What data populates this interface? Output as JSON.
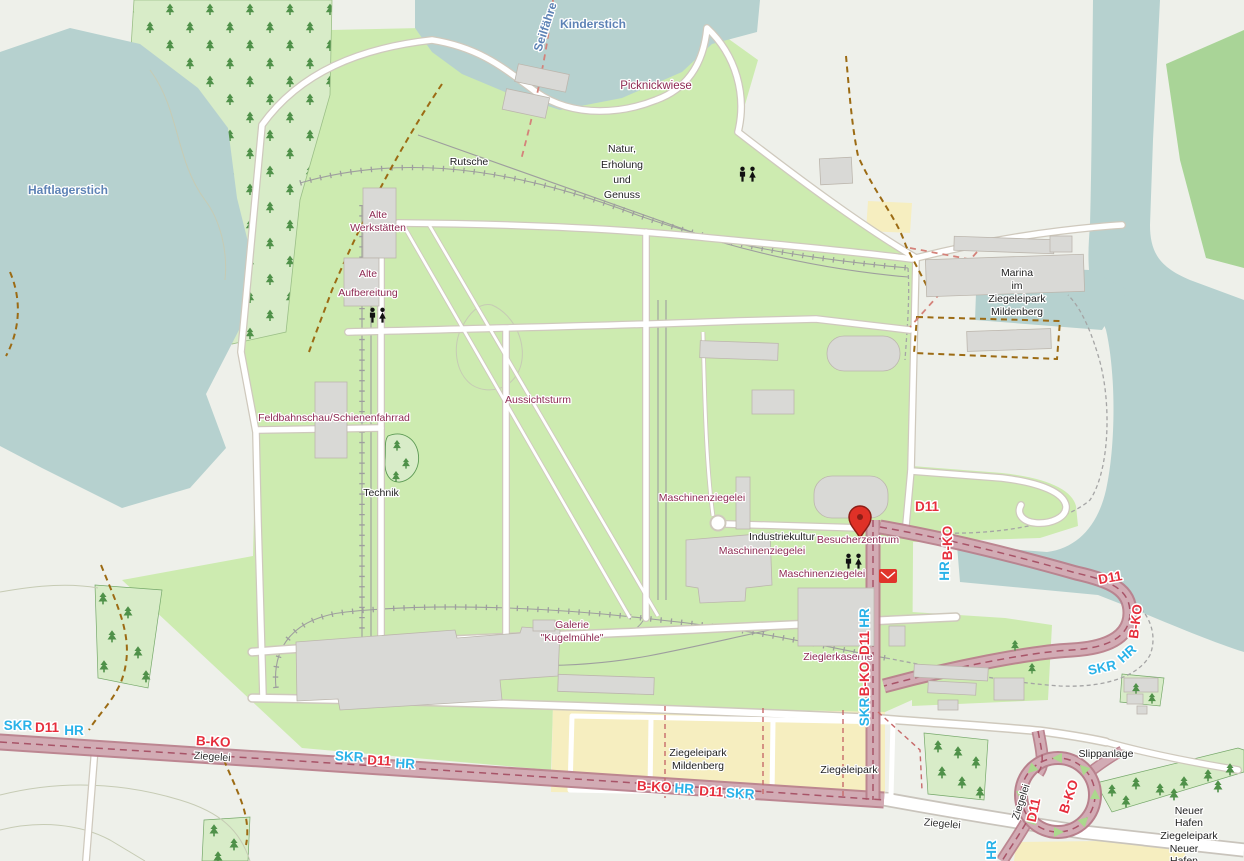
{
  "colors": {
    "water": "#b6d1cf",
    "grass": "#cdebb0",
    "wood": "#a9d497",
    "forest": "#d8ecc8",
    "sand": "#f6eec0",
    "building": "#d9d9d6",
    "route_overlay": "#d2abb4",
    "route_casing": "#b8808c",
    "route_red": "#e62e3c",
    "route_cyan": "#29b2e8",
    "poi_label": "#8e2a52",
    "general_label": "#222222",
    "water_label": "#5d82b5",
    "street_label": "#333333",
    "trail": "#9c6b14",
    "railway": "#9e9e9e"
  },
  "labels": {
    "water": [
      {
        "name": "seilfaehre",
        "text": "Seilfähre"
      },
      {
        "name": "kinderstich",
        "text": "Kinderstich"
      },
      {
        "name": "haftlagerstich",
        "text": "Haftlagerstich"
      }
    ],
    "poi": [
      {
        "name": "picknickwiese",
        "text": "Picknickwiese"
      },
      {
        "name": "alte-werkstaetten",
        "lines": [
          "Alte",
          "Werkstätten"
        ]
      },
      {
        "name": "alte-aufbereitung",
        "lines": [
          "Alte",
          "Aufbereitung"
        ]
      },
      {
        "name": "feldbahnschau",
        "text": "Feldbahnschau/Schienenfahrrad"
      },
      {
        "name": "aussichtsturm",
        "text": "Aussichtsturm"
      },
      {
        "name": "maschinenziegelei-nw",
        "text": "Maschinenziegelei"
      },
      {
        "name": "maschinenziegelei-mid",
        "text": "Maschinenziegelei"
      },
      {
        "name": "maschinenziegelei-se",
        "text": "Maschinenziegelei"
      },
      {
        "name": "besucherzentrum",
        "text": "Besucherzentrum"
      },
      {
        "name": "galerie-kugelmuehle",
        "lines": [
          "Galerie",
          "\"Kugelmühle\""
        ]
      },
      {
        "name": "zieglerkaserne",
        "text": "Zieglerkaserne"
      }
    ],
    "general": [
      {
        "name": "rutsche",
        "text": "Rutsche"
      },
      {
        "name": "natur-erholung",
        "lines": [
          "Natur,",
          "Erholung",
          "und",
          "Genuss"
        ]
      },
      {
        "name": "industriekultur",
        "text": "Industriekultur"
      },
      {
        "name": "technik",
        "text": "Technik"
      },
      {
        "name": "marina",
        "lines": [
          "Marina",
          "im",
          "Ziegeleipark",
          "Mildenberg"
        ]
      },
      {
        "name": "ziegeleipark-mildenberg",
        "lines": [
          "Ziegeleipark",
          "Mildenberg"
        ]
      },
      {
        "name": "ziegeleipark",
        "text": "Ziegeleipark"
      },
      {
        "name": "slippanlage",
        "text": "Slippanlage"
      },
      {
        "name": "neuer-hafen-ziegeleipark",
        "lines": [
          "Neuer",
          "Hafen",
          "Ziegeleipark"
        ]
      },
      {
        "name": "neuer-hafen",
        "lines": [
          "Neuer",
          "Hafen"
        ]
      }
    ],
    "streets": [
      {
        "name": "ziegelei-west",
        "text": "Ziegelei"
      },
      {
        "name": "ziegelei-east",
        "text": "Ziegelei"
      },
      {
        "name": "ziegelei-loop",
        "text": "Ziegelei"
      }
    ],
    "routes": [
      {
        "text": "SKR",
        "color": "cyan"
      },
      {
        "text": "D11",
        "color": "red"
      },
      {
        "text": "HR",
        "color": "cyan"
      },
      {
        "text": "B-KO",
        "color": "red"
      },
      {
        "text": "SKR",
        "color": "cyan"
      },
      {
        "text": "D11",
        "color": "red"
      },
      {
        "text": "HR",
        "color": "cyan"
      },
      {
        "text": "B-KO",
        "color": "red"
      },
      {
        "text": "HR",
        "color": "cyan"
      },
      {
        "text": "D11",
        "color": "red"
      },
      {
        "text": "SKR",
        "color": "cyan"
      },
      {
        "text": "D11",
        "color": "red"
      },
      {
        "text": "B-KO",
        "color": "red"
      },
      {
        "text": "HR",
        "color": "cyan"
      },
      {
        "text": "D11",
        "color": "red"
      },
      {
        "text": "B-KO",
        "color": "red"
      },
      {
        "text": "HR",
        "color": "cyan"
      },
      {
        "text": "SKR",
        "color": "cyan"
      },
      {
        "text": "HR",
        "color": "cyan"
      },
      {
        "text": "D11",
        "color": "red"
      },
      {
        "text": "B-KO",
        "color": "red"
      },
      {
        "text": "SKR",
        "color": "cyan"
      },
      {
        "text": "D11",
        "color": "red"
      },
      {
        "text": "B-KO",
        "color": "red"
      },
      {
        "text": "HR",
        "color": "cyan"
      }
    ]
  },
  "icons": {
    "visitor_pin": "red map marker",
    "toilets": "restroom two-figure pictogram",
    "postbox": "red envelope post box",
    "oneway_arrow": "green triangle arrow",
    "conifer": "conifer tree symbol"
  }
}
